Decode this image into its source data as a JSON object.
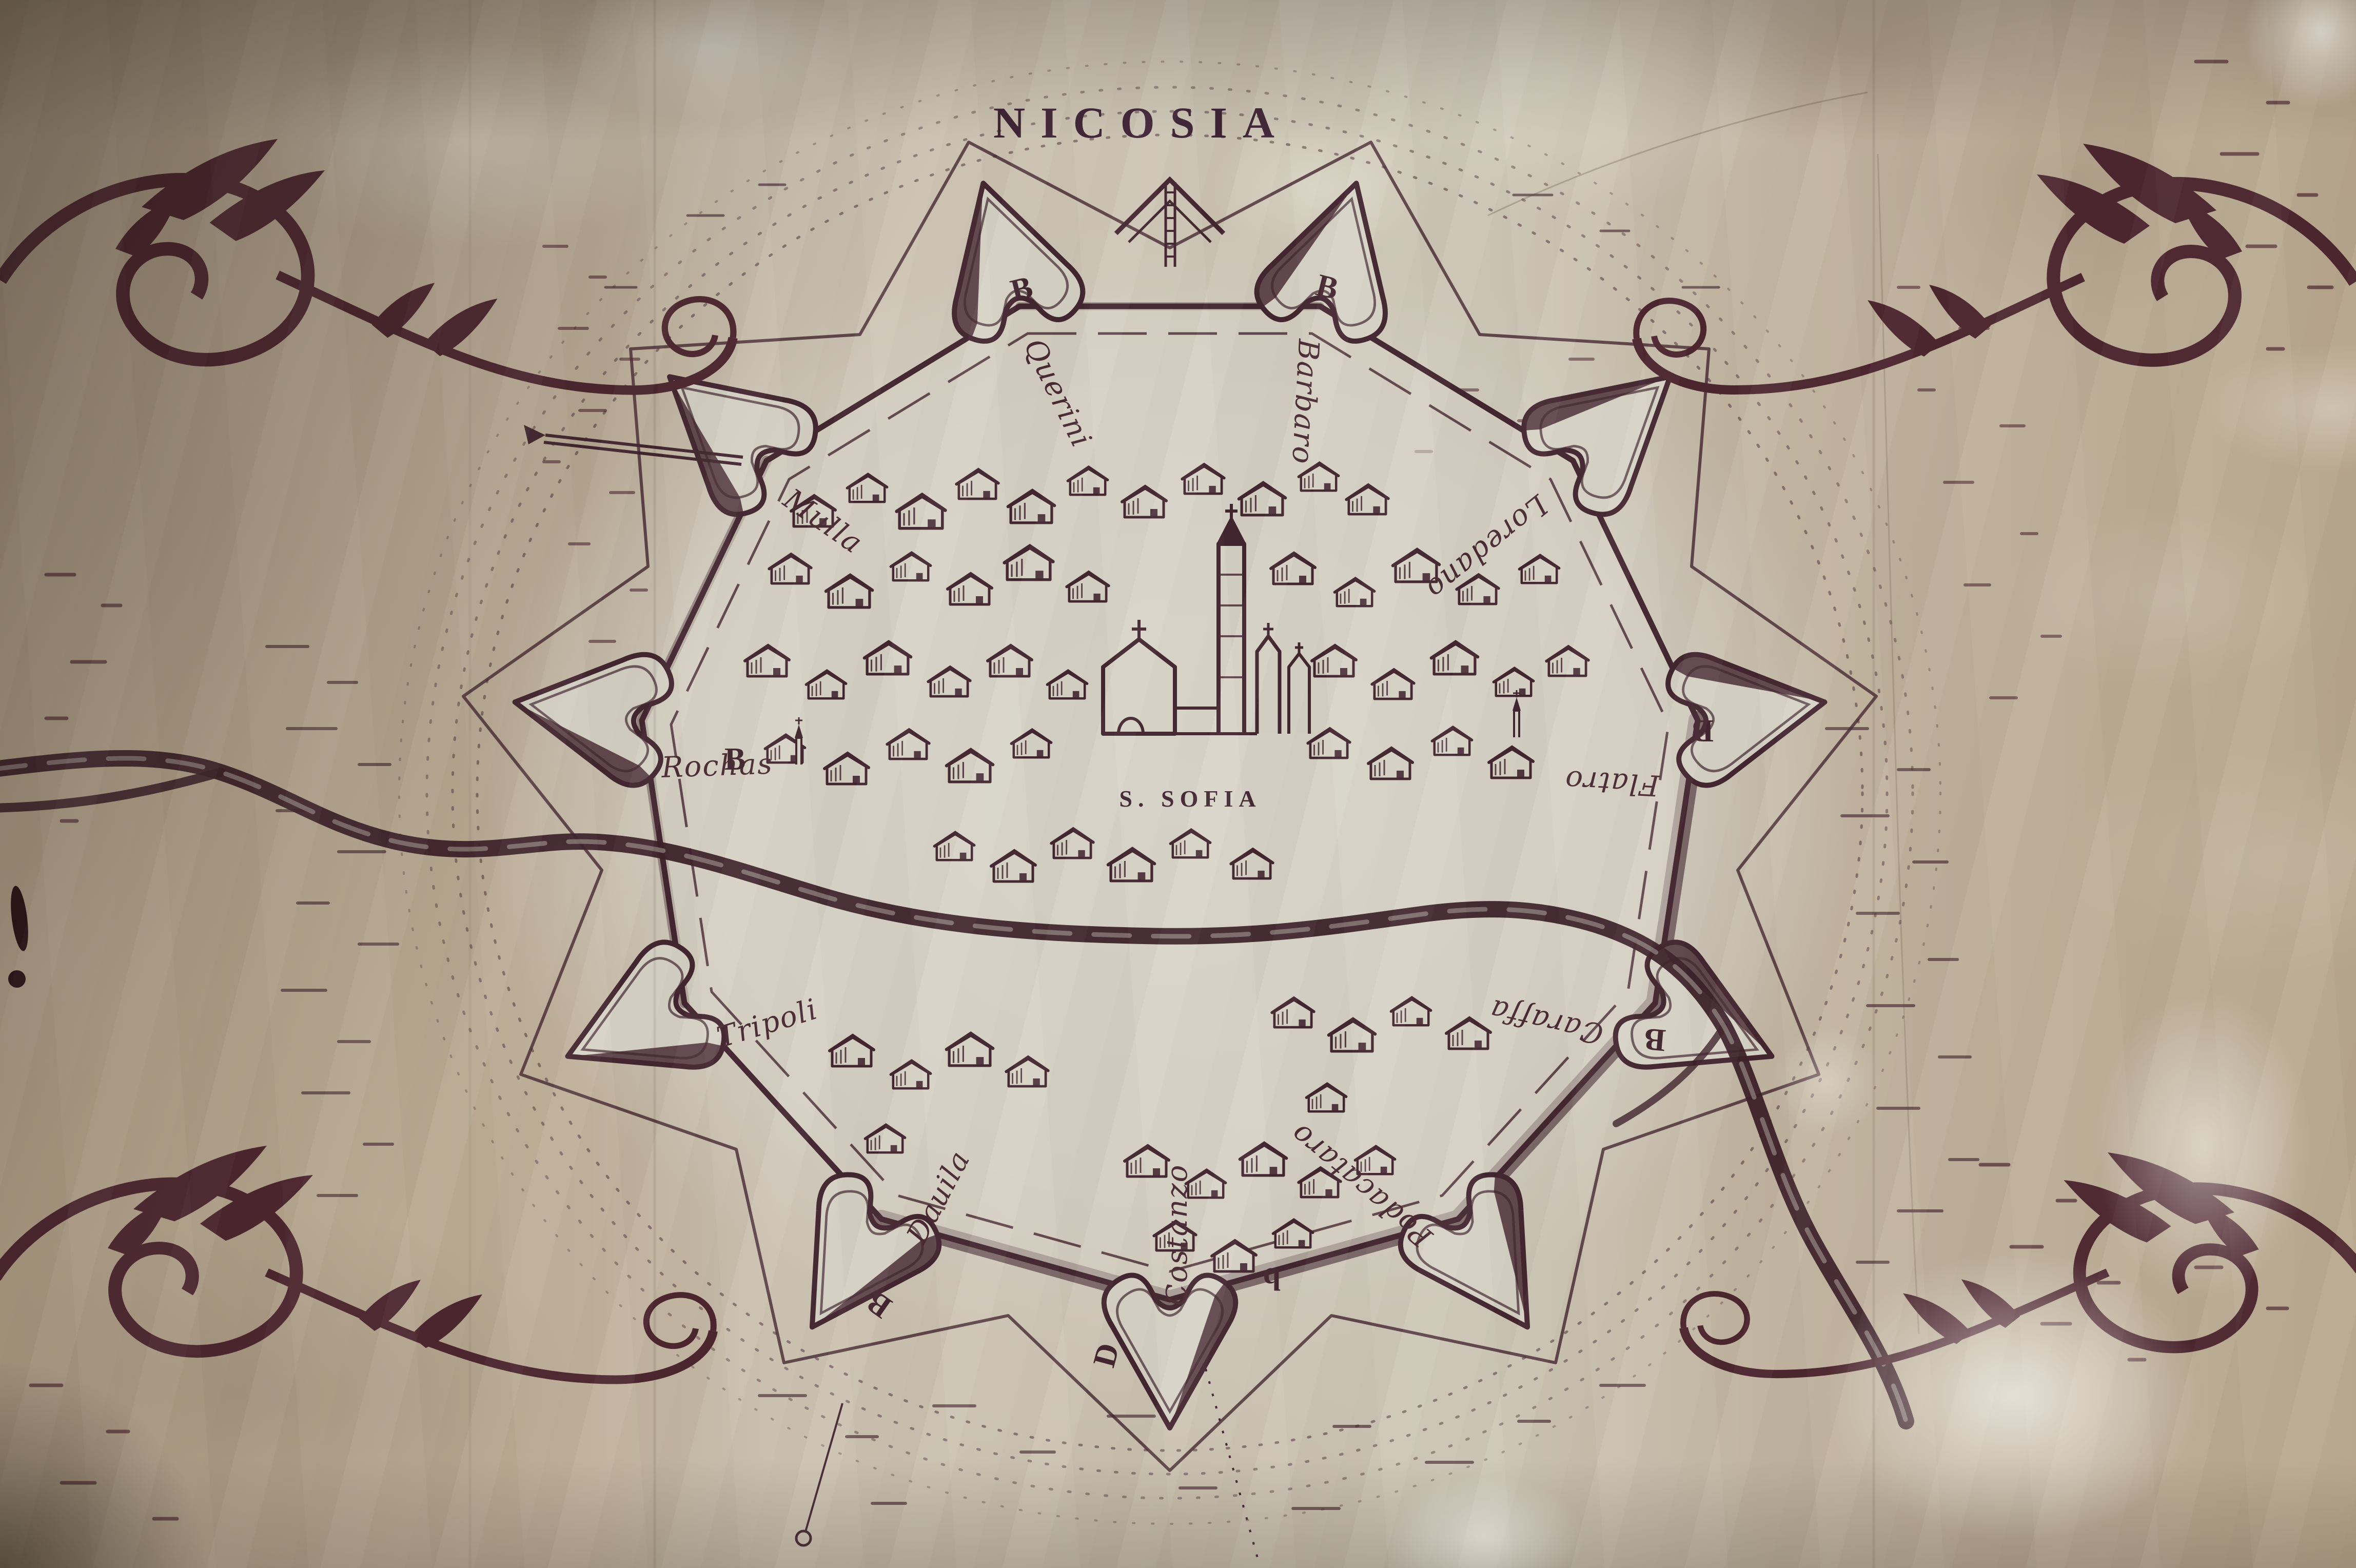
{
  "map": {
    "title": "NICOSIA",
    "cathedral_label": "S. SOFIA",
    "bastion_labels": [
      "Querini",
      "Barbaro",
      "Loredano",
      "Flatro",
      "Caraffa",
      "Podacataro",
      "Costanzo",
      "Dauila",
      "Tripoli",
      "Rochas",
      "Mulla"
    ],
    "bastion_letters": [
      "B",
      "B",
      "B",
      "B",
      "B",
      "B",
      "b",
      "D"
    ],
    "colors": {
      "ink": "#432630",
      "paper": "#d8d3c7",
      "fabric": "#bfb19c"
    }
  }
}
